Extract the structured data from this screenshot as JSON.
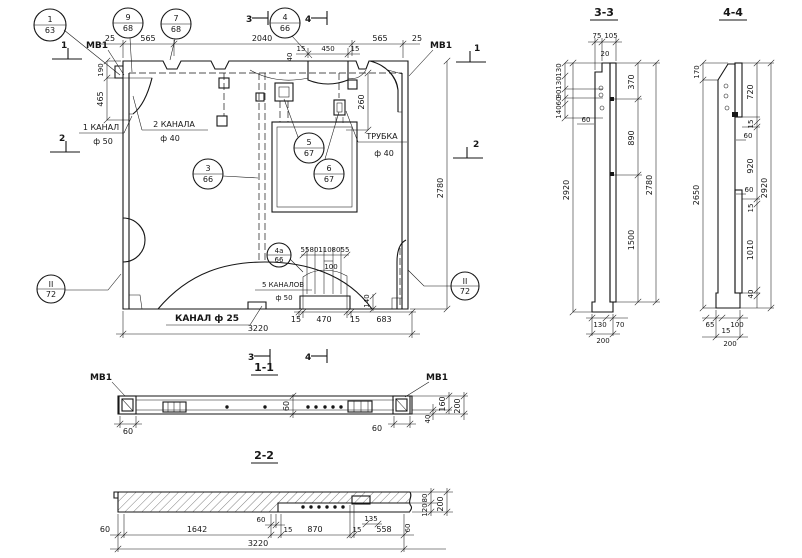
{
  "meta": {
    "ink": "#161616",
    "paper": "#ffffff"
  },
  "main": {
    "mv1_left": "МВ1",
    "mv1_right": "МВ1",
    "label_kanal1_line1": "1 КАНАЛ",
    "label_kanal1_line2": "ф 50",
    "label_kanal2_line1": "2 КАНАЛА",
    "label_kanal2_line2": "ф 40",
    "label_trubka_line1": "ТРУБКА",
    "label_trubka_line2": "ф 40",
    "label_kanal5_line1": "5 КАНАЛОВ",
    "label_kanal5_line2": "ф 50",
    "label_kanal25": "КАНАЛ ф 25",
    "callout_1_num": "1",
    "callout_1_sheet": "63",
    "callout_9_num": "9",
    "callout_9_sheet": "68",
    "callout_7_num": "7",
    "callout_7_sheet": "68",
    "callout_4_num": "4",
    "callout_4_sheet": "66",
    "callout_3_num": "3",
    "callout_3_sheet": "66",
    "callout_5_num": "5",
    "callout_5_sheet": "67",
    "callout_6_num": "6",
    "callout_6_sheet": "67",
    "callout_4a_num": "4а",
    "callout_4a_sheet": "66",
    "callout_II_left_num": "II",
    "callout_II_left_sheet": "72",
    "callout_II_right_num": "II",
    "callout_II_right_sheet": "72",
    "mark_1_left": "1",
    "mark_2_left": "2",
    "mark_1_right": "1",
    "mark_2_right": "2",
    "mark_3_top": "3",
    "mark_4_top": "4",
    "mark_3_bottom": "3",
    "mark_4_bottom": "4",
    "dim_25_left": "25",
    "dim_565_left": "565",
    "dim_2040": "2040",
    "dim_565_right": "565",
    "dim_25_right": "25",
    "dim_15_a": "15",
    "dim_450": "450",
    "dim_15_b": "15",
    "dim_40_top": "40",
    "dim_190": "190",
    "dim_465": "465",
    "dim_260": "260",
    "dim_2780": "2780",
    "dim_55_a": "55",
    "dim_80_a": "80",
    "dim_110": "110",
    "dim_80_b": "80",
    "dim_55_b": "55",
    "dim_100": "100",
    "dim_140": "140",
    "dim_15_c": "15",
    "dim_470": "470",
    "dim_15_d": "15",
    "dim_683": "683",
    "dim_3220": "3220"
  },
  "section11": {
    "title": "1-1",
    "mv1_left": "МВ1",
    "mv1_right": "МВ1",
    "dim_60_left": "60",
    "dim_60_mid": "60",
    "dim_60_right": "60",
    "dim_40": "40",
    "dim_160": "160",
    "dim_200": "200"
  },
  "section22": {
    "title": "2-2",
    "dim_60_left": "60",
    "dim_1642": "1642",
    "dim_60_step": "60",
    "dim_15_a": "15",
    "dim_870": "870",
    "dim_135": "135",
    "dim_15_b": "15",
    "dim_558": "558",
    "dim_60_right": "60",
    "dim_3220": "3220",
    "dim_80": "80",
    "dim_120": "120",
    "dim_200": "200"
  },
  "section33": {
    "title": "3-3",
    "dim_75": "75",
    "dim_105": "105",
    "dim_20": "20",
    "dim_130_a": "130",
    "dim_130_b": "130",
    "dim_90": "90",
    "dim_60_stack": "60",
    "dim_140": "140",
    "dim_60_wall": "60",
    "dim_2920": "2920",
    "dim_370": "370",
    "dim_890": "890",
    "dim_1500": "1500",
    "dim_2780": "2780",
    "dim_130_foot": "130",
    "dim_70": "70",
    "dim_200": "200"
  },
  "section44": {
    "title": "4-4",
    "dim_170": "170",
    "dim_720": "720",
    "dim_15_a": "15",
    "dim_60_a": "60",
    "dim_920": "920",
    "dim_60_b": "60",
    "dim_15_b": "15",
    "dim_1010": "1010",
    "dim_40": "40",
    "dim_2920": "2920",
    "dim_2650": "2650",
    "dim_65": "65",
    "dim_15_c": "15",
    "dim_100": "100",
    "dim_200": "200"
  }
}
